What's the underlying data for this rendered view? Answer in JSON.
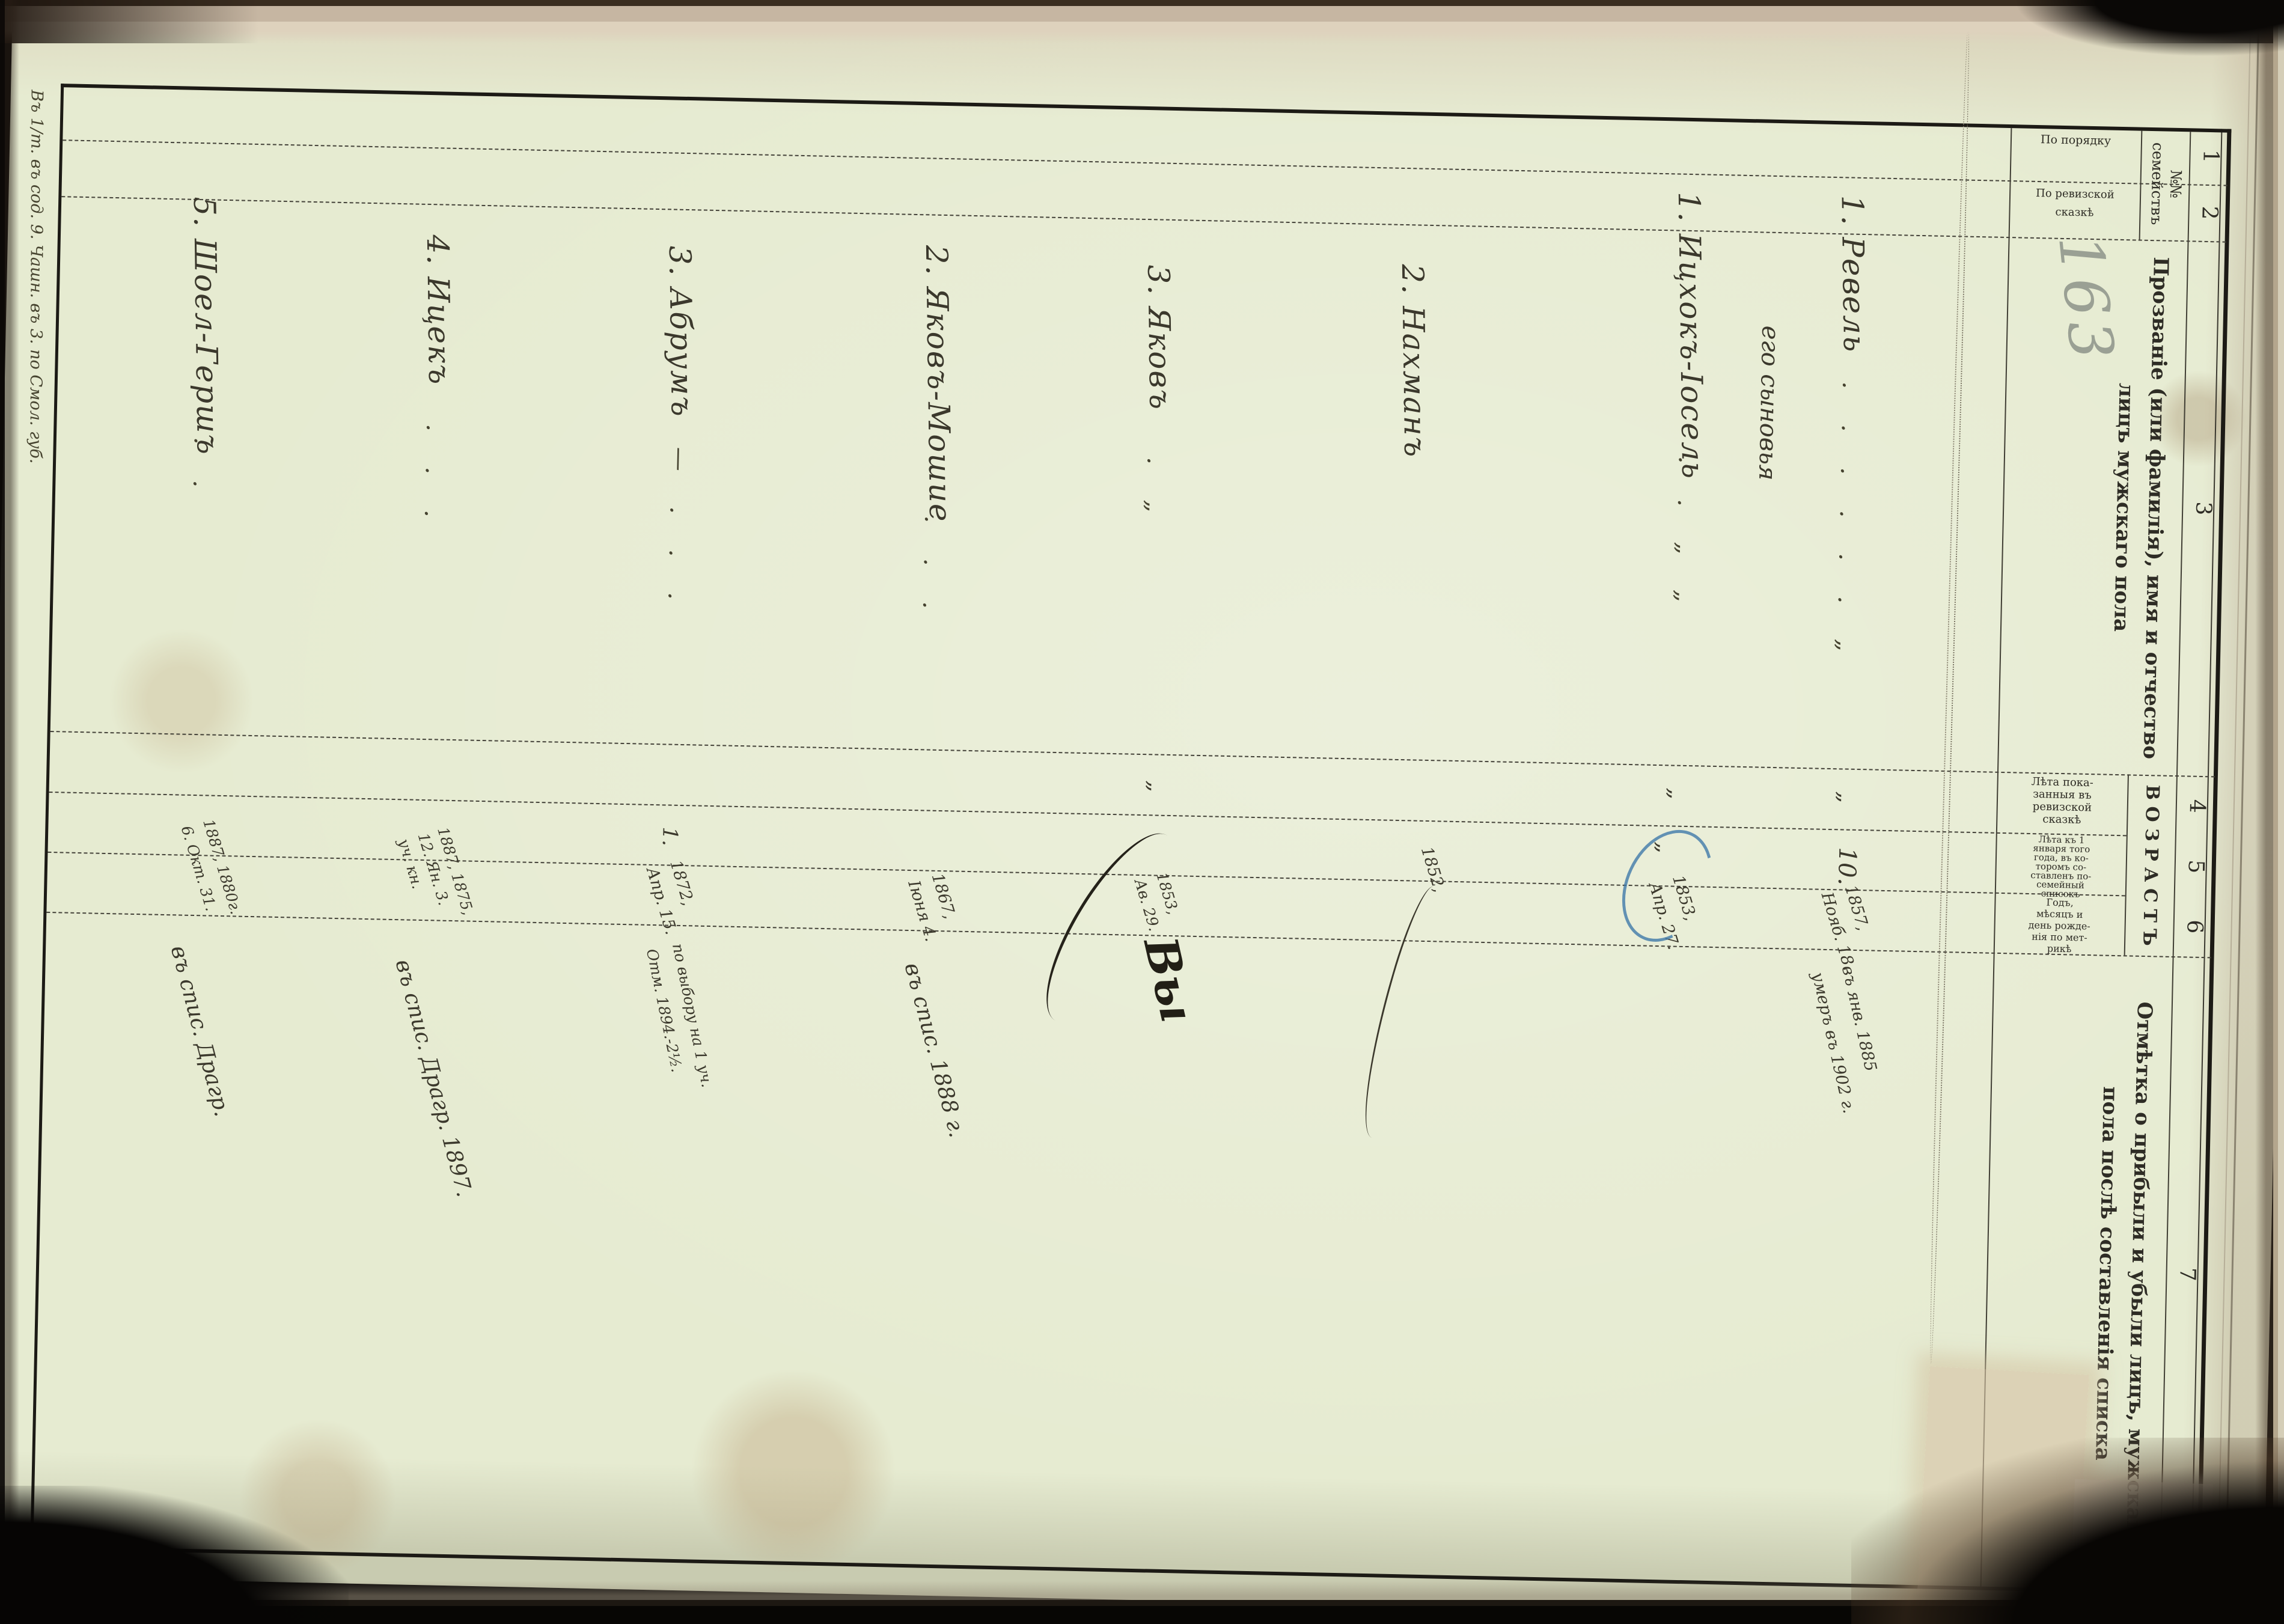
{
  "document": {
    "pencil_number": "163",
    "margin_note": "Въ 1/т. въ сод. 9. Чашн. въ 3. по Смол. губ.",
    "header": {
      "numbers": [
        "1",
        "2",
        "3",
        "4",
        "5",
        "6",
        "7"
      ],
      "family_group": "№№\nсемействъ",
      "col1": "По порядку",
      "col2": "По ревизской\nсказкѣ",
      "col3": "Прозваніе (или фамилія), имя и отчество лицъ мужскаго пола",
      "age_group": "В О З Р А С Т Ъ",
      "col4": "Лѣта пока-\nзанныя въ\nревизской\nсказкѣ",
      "col5": "Лѣта къ 1\nянваря того\nгода, въ ко-\nторомъ со-\nставленъ по-\nсемейный\nсписокъ",
      "col6": "Годъ,\nмѣсяцъ и\nдень рожде-\nнія по мет-\nрикѣ",
      "col7": "Отмѣтка о прибыли и убыли лицъ, мужскаго пола послѣ составленія списка"
    },
    "entries": [
      {
        "name": "1. Ревель",
        "dots": ". . . . . . „",
        "col4": "„",
        "col5": "10.",
        "col6": "1857,\nНояб. 18.",
        "col7": "въ янв. 1885\nумеръ въ 1902 г."
      },
      {
        "name": "его сыновья"
      },
      {
        "name": "1. Ицхокъ-Іосель",
        "dots": ". . „ „",
        "col4": "„",
        "col5": "„",
        "col6": "1853,\nАпр. 27."
      },
      {
        "name": "2. Нахманъ",
        "col6": "1852,"
      },
      {
        "name": "3. Яковъ",
        "dots": ". „",
        "col4": "„",
        "col6": "1853,\nАв. 29.",
        "col7": "Вы"
      },
      {
        "name": "2. Яковъ-Мошие",
        "dots": ". . .",
        "col6": "1867,\nІюня 4.",
        "col7": "въ спис. 1888 г."
      },
      {
        "name": "3. Абрумъ",
        "dots": "— . . .",
        "col5": "1.",
        "col6": "1872,\nАпр. 15.",
        "col7": "по выбору на 1 уч.\nОтм. 1894.-2½."
      },
      {
        "name": "4. Ицекъ",
        "dots": ". . .",
        "col45": "1887, 1875,\n12. Ян. 3.\nуч. кн.",
        "col7": "въ спис. Драгр. 1897."
      },
      {
        "name": "5. Шоел-Гершъ",
        "dots": ". .",
        "col45": "1887, 1880г.\n6. Окт. 31.",
        "col7": "въ спис. Драгр."
      }
    ]
  }
}
